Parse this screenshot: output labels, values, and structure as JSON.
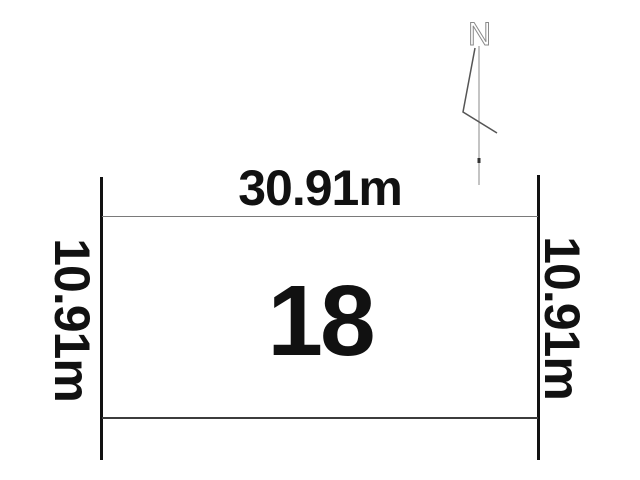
{
  "diagram": {
    "plot_number": "18",
    "top_dimension": "30.91m",
    "left_dimension": "10.91m",
    "right_dimension": "10.91m",
    "north_label": "N"
  },
  "colors": {
    "background": "#ffffff",
    "boundary_line": "#111111",
    "parcel_edge_top": "#7a7a7a",
    "parcel_edge_bottom": "#3c3c3c",
    "text": "#111111",
    "north_arrow": "#8a8a8a",
    "north_arrow_dark": "#555555"
  }
}
